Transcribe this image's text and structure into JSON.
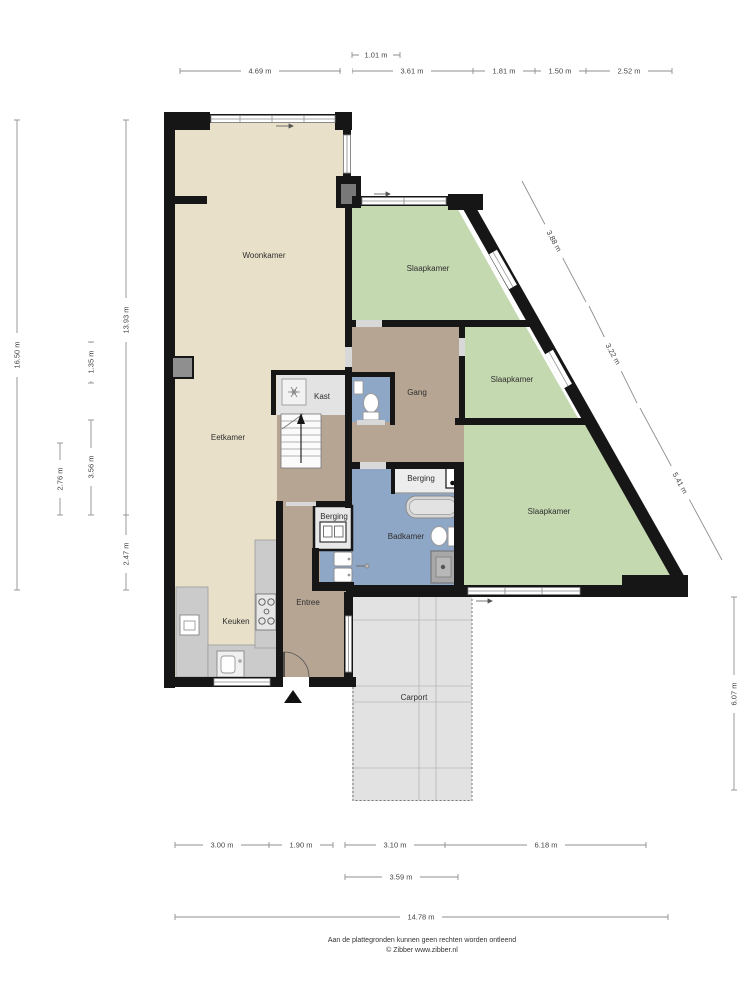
{
  "plan": {
    "rooms": {
      "woonkamer": "Woonkamer",
      "slaapkamer_top": "Slaapkamer",
      "slaapkamer_mid": "Slaapkamer",
      "slaapkamer_bottom": "Slaapkamer",
      "eetkamer": "Eetkamer",
      "kast": "Kast",
      "gang": "Gang",
      "berging_badkamer": "Berging",
      "berging_hal": "Berging",
      "badkamer": "Badkamer",
      "keuken": "Keuken",
      "entree": "Entree",
      "carport": "Carport"
    },
    "dimensions": {
      "top_small": "1.01 m",
      "top": [
        "4.69 m",
        "3.61 m",
        "1.81 m",
        "1.50 m",
        "2.52 m"
      ],
      "left": [
        "16.50 m",
        "13.93 m",
        "1.35 m",
        "3.56 m",
        "2.76 m",
        "2.47 m"
      ],
      "right_diagonal": [
        "3.88 m",
        "3.22 m",
        "5.41 m"
      ],
      "right_vertical": "6.07 m",
      "bottom_row1": [
        "3.00 m",
        "1.90 m",
        "3.10 m",
        "6.18 m"
      ],
      "bottom_row2": "3.59 m",
      "bottom_total": "14.78 m"
    },
    "footer": {
      "disclaimer": "Aan de plattegronden kunnen geen rechten worden ontleend",
      "copyright": "© Zibber www.zibber.nl"
    },
    "colors": {
      "wall": "#161616",
      "living_floor": "#e8e0c8",
      "bedroom_floor": "#c5d9b0",
      "hall_floor": "#b6a593",
      "bath_floor": "#8fa7c6",
      "storage_floor": "#e8e8e8",
      "carport_floor": "#e2e2e2",
      "dim_line": "#8f8f8f"
    }
  }
}
